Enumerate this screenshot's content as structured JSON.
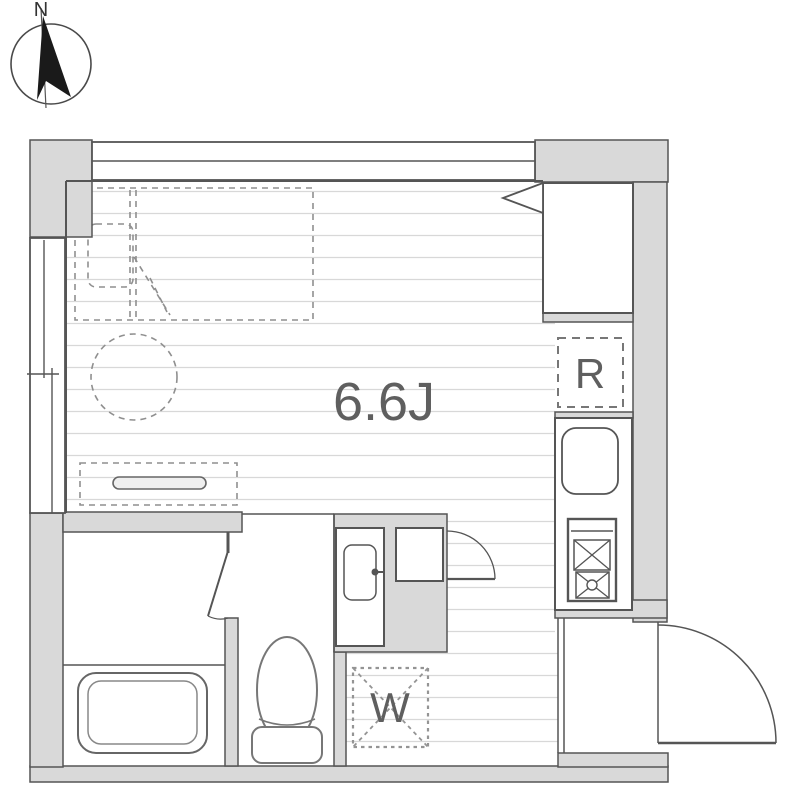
{
  "title": "Apartment floor plan",
  "compass": {
    "north_label": "N"
  },
  "floor_plan": {
    "main_room": {
      "size_label": "6.6J"
    },
    "kitchen": {
      "refrigerator_label": "R"
    },
    "laundry": {
      "washer_label": "W"
    }
  },
  "colors": {
    "wall_fill": "#d9d9d9",
    "outline": "#555555",
    "floor_line": "#d8d8d8",
    "dashed_furniture": "#8f8f8f",
    "label_text": "#5f5f5f",
    "compass_needle": "#1a1a1a"
  }
}
